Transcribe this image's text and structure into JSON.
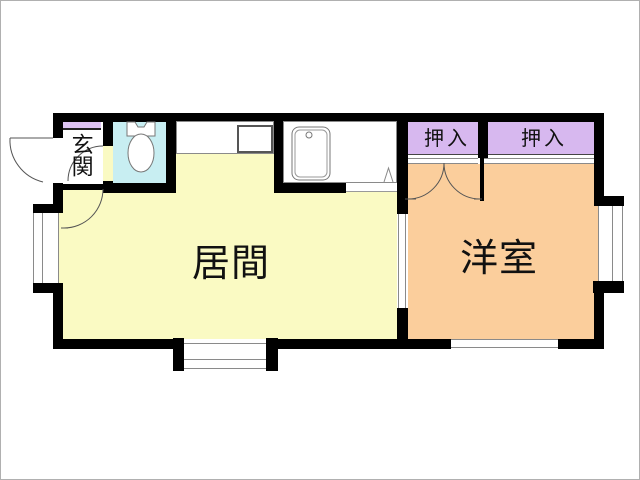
{
  "plan": {
    "title_hint": "apartment floor plan",
    "rooms": {
      "genkan": {
        "label": "玄関"
      },
      "living": {
        "label": "居間"
      },
      "western": {
        "label": "洋室"
      },
      "closet1": {
        "label": "押入"
      },
      "closet2": {
        "label": "押入"
      }
    }
  },
  "colors": {
    "wall": "#000000",
    "line": "#8a8a8a",
    "label": "#111111",
    "living-bg": "#fafac3",
    "western-bg": "#fbce9c",
    "closet-bg": "#d7b8ef",
    "toilet-bg": "#c8eef2",
    "genkan-step": "#ddc3f2"
  }
}
